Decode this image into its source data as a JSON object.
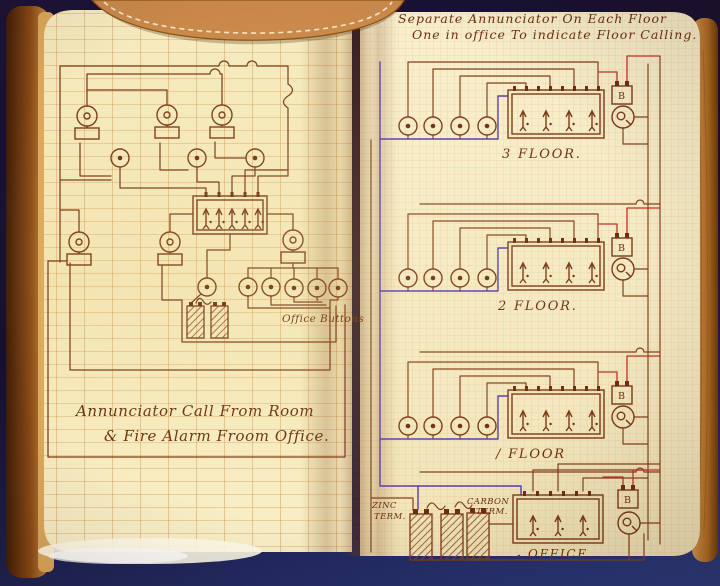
{
  "photo": {
    "left_page": {
      "caption_line1": "Annunciator Call From Room",
      "caption_line2": "& Fire Alarm Froom Office.",
      "office_buttons_label": "Office Buttons"
    },
    "right_page": {
      "title_line1": "Separate Annunciator On Each Floor",
      "title_line2": "One in office To indicate Floor Calling.",
      "floor_3_label": "3 FLOOR.",
      "floor_2_label": "2 FLOOR.",
      "floor_1_label": "/ FLOOR",
      "office_label": "OFFICE.",
      "battery_label": "B",
      "zinc_term_line1": "ZINC",
      "zinc_term_line2": "TERM.",
      "carbon_term_line1": "CARBON",
      "carbon_term_line2": "TERM."
    },
    "colors": {
      "background_navy": "#1a1238",
      "page_cream": "#f4ebc1",
      "ink_brown": "#7c3a16",
      "ink_purple": "#5b3cae",
      "ink_red": "#c23326",
      "leather_tan": "#c5873f",
      "grid_left_line": "#ce803c",
      "grid_right_line": "#e48c80"
    }
  }
}
